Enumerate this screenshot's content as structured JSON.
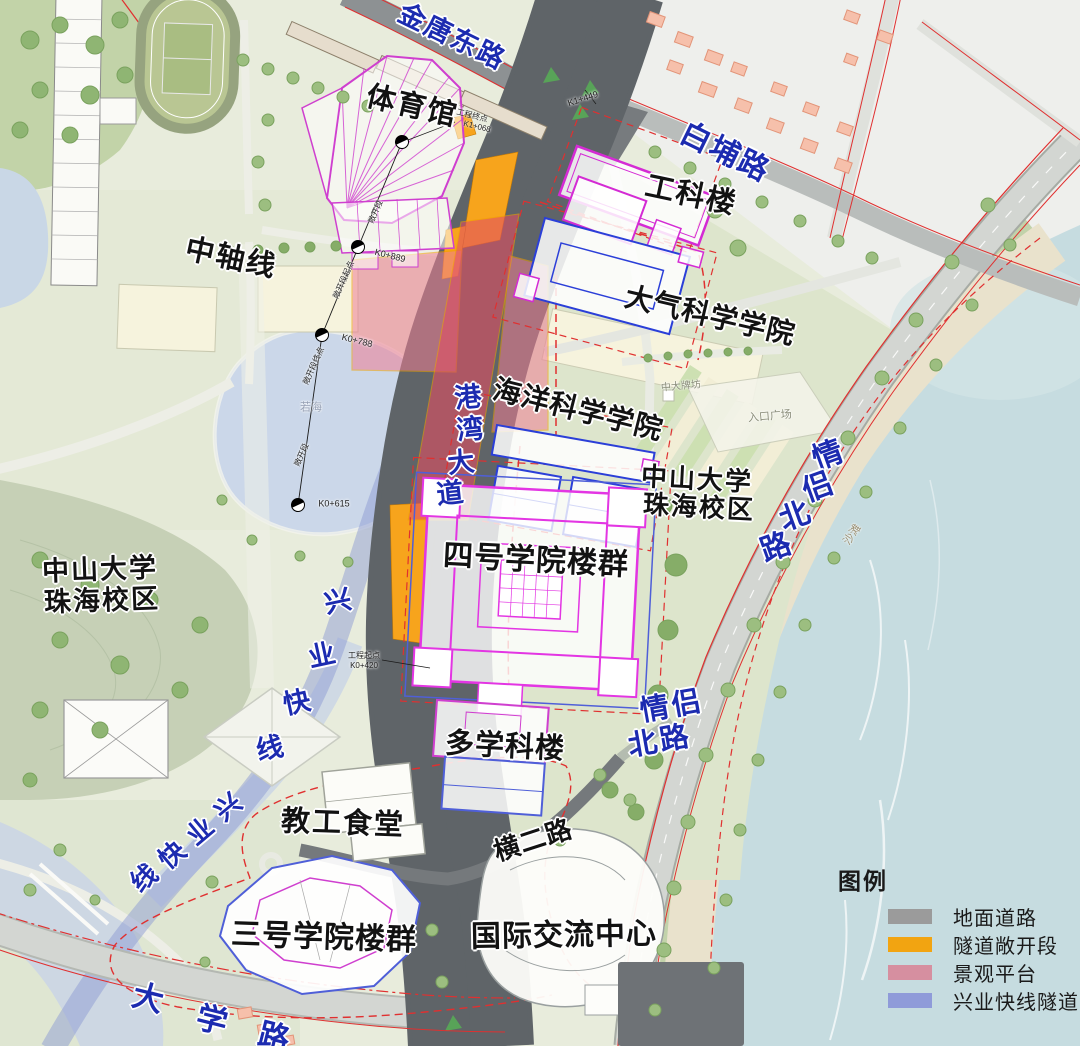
{
  "legend": {
    "title": "图例",
    "items": [
      {
        "name": "ground-road",
        "label": "地面道路",
        "color": "#9b9b9b"
      },
      {
        "name": "tunnel-open-section",
        "label": "隧道敞开段",
        "color": "#f2a411"
      },
      {
        "name": "landscape-platform",
        "label": "景观平台",
        "color": "#d68fa0"
      },
      {
        "name": "xingye-express-tunnel",
        "label": "兴业快线隧道",
        "color": "#8f9bd9"
      }
    ]
  },
  "labels": [
    {
      "name": "road-label-jintang-east",
      "text": "金唐东路",
      "x": 452,
      "y": 37,
      "rot": 26,
      "size": 27,
      "cls": "road",
      "spacing": 2
    },
    {
      "name": "road-label-baipu",
      "text": "白埔路",
      "x": 725,
      "y": 153,
      "rot": 26,
      "size": 30,
      "cls": "road",
      "spacing": 2
    },
    {
      "name": "road-label-qinglv-north-upper",
      "text": "情侣北路",
      "cls": "road",
      "rot": -20,
      "size": 30,
      "chars": [
        {
          "t": "情",
          "x": 828,
          "y": 456
        },
        {
          "t": "侣",
          "x": 818,
          "y": 488
        },
        {
          "t": "北",
          "x": 795,
          "y": 517
        },
        {
          "t": "路",
          "x": 776,
          "y": 548
        }
      ]
    },
    {
      "name": "road-label-qinglv-north-lower-1",
      "text": "情侣",
      "x": 672,
      "y": 707,
      "rot": -10,
      "size": 29,
      "cls": "road",
      "spacing": 3
    },
    {
      "name": "road-label-qinglv-north-lower-2",
      "text": "北路",
      "x": 660,
      "y": 742,
      "rot": -10,
      "size": 29,
      "cls": "road",
      "spacing": 3
    },
    {
      "name": "road-label-gangwan-avenue",
      "text": "港湾大道",
      "cls": "road",
      "rot": -6,
      "size": 27,
      "chars": [
        {
          "t": "港",
          "x": 468,
          "y": 398
        },
        {
          "t": "湾",
          "x": 470,
          "y": 430
        },
        {
          "t": "大",
          "x": 461,
          "y": 463
        },
        {
          "t": "道",
          "x": 450,
          "y": 494
        }
      ]
    },
    {
      "name": "road-label-daxue",
      "text": "大学路",
      "cls": "road",
      "rot": 14,
      "size": 31,
      "chars": [
        {
          "t": "大",
          "x": 148,
          "y": 998
        },
        {
          "t": "学",
          "x": 212,
          "y": 1020
        },
        {
          "t": "路",
          "x": 274,
          "y": 1037
        }
      ]
    },
    {
      "name": "rail-label-xingye-vertical",
      "text": "兴业快线",
      "cls": "road",
      "rot": -12,
      "size": 27,
      "chars": [
        {
          "t": "兴",
          "x": 338,
          "y": 602
        },
        {
          "t": "业",
          "x": 322,
          "y": 656
        },
        {
          "t": "快",
          "x": 297,
          "y": 703
        },
        {
          "t": "线",
          "x": 270,
          "y": 749
        }
      ]
    },
    {
      "name": "rail-label-xingye-diagonal",
      "text": "兴业快线",
      "cls": "road",
      "rot": -40,
      "size": 26,
      "chars": [
        {
          "t": "兴",
          "x": 228,
          "y": 807
        },
        {
          "t": "业",
          "x": 200,
          "y": 831
        },
        {
          "t": "快",
          "x": 172,
          "y": 855
        },
        {
          "t": "线",
          "x": 144,
          "y": 878
        }
      ]
    },
    {
      "name": "place-label-gymnasium",
      "text": "体育馆",
      "x": 412,
      "y": 107,
      "rot": 13,
      "size": 29,
      "cls": "place",
      "spacing": 2
    },
    {
      "name": "place-label-engineering-building",
      "text": "工科楼",
      "x": 691,
      "y": 196,
      "rot": 12,
      "size": 29,
      "cls": "place",
      "spacing": 2
    },
    {
      "name": "place-label-atmospheric-science-college",
      "text": "大气科学学院",
      "x": 710,
      "y": 316,
      "rot": 13,
      "size": 28,
      "cls": "place",
      "spacing": 1
    },
    {
      "name": "place-label-central-axis",
      "text": "中轴线",
      "x": 231,
      "y": 259,
      "rot": 12,
      "size": 29,
      "cls": "place",
      "spacing": 2
    },
    {
      "name": "place-label-ocean-science-college",
      "text": "海洋科学学院",
      "x": 578,
      "y": 410,
      "rot": 14,
      "size": 28,
      "cls": "place",
      "spacing": 1
    },
    {
      "name": "place-label-zsu-campus-right-1",
      "text": "中山大学",
      "x": 697,
      "y": 479,
      "rot": 3,
      "size": 26,
      "cls": "place",
      "spacing": 2
    },
    {
      "name": "place-label-zsu-campus-right-2",
      "text": "珠海校区",
      "x": 699,
      "y": 507,
      "rot": 3,
      "size": 26,
      "cls": "place",
      "spacing": 2
    },
    {
      "name": "place-label-no4-college-complex",
      "text": "四号学院楼群",
      "x": 536,
      "y": 561,
      "rot": 3,
      "size": 30,
      "cls": "place",
      "spacing": 1
    },
    {
      "name": "place-label-multidisciplinary-building",
      "text": "多学科楼",
      "x": 505,
      "y": 747,
      "rot": 3,
      "size": 29,
      "cls": "place",
      "spacing": 1
    },
    {
      "name": "place-label-zsu-campus-left-1",
      "text": "中山大学",
      "x": 100,
      "y": 570,
      "rot": -2,
      "size": 27,
      "cls": "place",
      "spacing": 2
    },
    {
      "name": "place-label-zsu-campus-left-2",
      "text": "珠海校区",
      "x": 102,
      "y": 601,
      "rot": -2,
      "size": 27,
      "cls": "place",
      "spacing": 2
    },
    {
      "name": "place-label-staff-canteen",
      "text": "教工食堂",
      "x": 343,
      "y": 824,
      "rot": 2,
      "size": 29,
      "cls": "place",
      "spacing": 2
    },
    {
      "name": "road-label-henger",
      "text": "横二路",
      "x": 533,
      "y": 840,
      "rot": -18,
      "size": 26,
      "cls": "place",
      "spacing": 1
    },
    {
      "name": "place-label-no3-college-complex",
      "text": "三号学院楼群",
      "x": 324,
      "y": 938,
      "rot": 2,
      "size": 30,
      "cls": "place",
      "spacing": 1
    },
    {
      "name": "place-label-intl-exchange-center",
      "text": "国际交流中心",
      "x": 564,
      "y": 936,
      "rot": -1,
      "size": 30,
      "cls": "place",
      "spacing": 1
    },
    {
      "name": "tiny-label-entrance-plaza",
      "text": "入口广场",
      "x": 770,
      "y": 417,
      "rot": -5,
      "size": 11,
      "cls": "tiny"
    },
    {
      "name": "tiny-label-zhongda-gate",
      "text": "中大牌坊",
      "x": 681,
      "y": 387,
      "rot": -5,
      "size": 10,
      "cls": "tiny"
    },
    {
      "name": "tiny-label-ruohai",
      "text": "若海",
      "x": 311,
      "y": 408,
      "rot": 0,
      "size": 11,
      "cls": "tiny",
      "color": "#96a0b4"
    },
    {
      "name": "tiny-label-beach",
      "text": "沙滩",
      "x": 853,
      "y": 535,
      "rot": -55,
      "size": 11,
      "cls": "tiny",
      "color": "#9a8f72"
    },
    {
      "name": "anno-k0-889",
      "text": "K0+889",
      "x": 390,
      "y": 256,
      "rot": 14,
      "size": 9,
      "cls": "anno"
    },
    {
      "name": "anno-k0-788",
      "text": "K0+788",
      "x": 357,
      "y": 341,
      "rot": 14,
      "size": 9,
      "cls": "anno"
    },
    {
      "name": "anno-k0-615",
      "text": "K0+615",
      "x": 334,
      "y": 504,
      "rot": 0,
      "size": 9,
      "cls": "anno"
    },
    {
      "name": "anno-k1-449",
      "text": "K1+449",
      "x": 583,
      "y": 99,
      "rot": -18,
      "size": 9,
      "cls": "anno"
    },
    {
      "name": "anno-project-end-1",
      "text": "工程终点",
      "x": 472,
      "y": 116,
      "rot": 14,
      "size": 8,
      "cls": "anno"
    },
    {
      "name": "anno-project-end-2",
      "text": "K1+068",
      "x": 477,
      "y": 127,
      "rot": 14,
      "size": 8,
      "cls": "anno"
    },
    {
      "name": "anno-project-start-1",
      "text": "工程起点",
      "x": 364,
      "y": 656,
      "rot": 0,
      "size": 8,
      "cls": "anno"
    },
    {
      "name": "anno-project-start-2",
      "text": "K0+420",
      "x": 364,
      "y": 666,
      "rot": 0,
      "size": 8,
      "cls": "anno"
    },
    {
      "name": "anno-open-section-start",
      "text": "敞开段起点",
      "x": 344,
      "y": 280,
      "rot": -66,
      "size": 8,
      "cls": "anno"
    },
    {
      "name": "anno-open-section-end",
      "text": "敞开段终点",
      "x": 314,
      "y": 366,
      "rot": -66,
      "size": 8,
      "cls": "anno"
    },
    {
      "name": "anno-open-section-a",
      "text": "敞开段",
      "x": 376,
      "y": 212,
      "rot": -66,
      "size": 8,
      "cls": "anno"
    },
    {
      "name": "anno-open-section-b",
      "text": "敞开段",
      "x": 302,
      "y": 455,
      "rot": -66,
      "size": 8,
      "cls": "anno"
    }
  ]
}
